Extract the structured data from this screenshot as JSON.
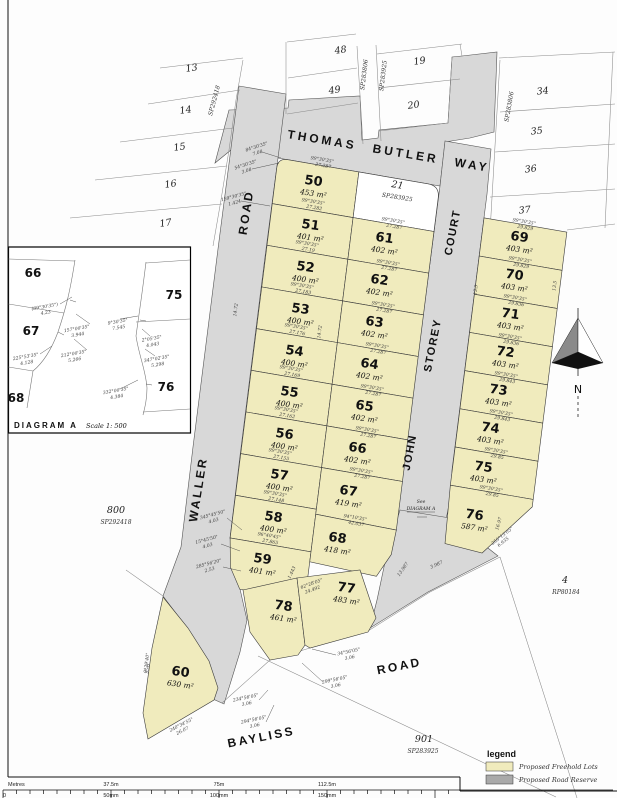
{
  "colors": {
    "lot_fill": "#f0ebbd",
    "road_fill": "#d8d8d8"
  },
  "map": {
    "roads": {
      "thomas_butler_way": "THOMAS BUTLER WAY",
      "waller": "WALLER",
      "waller_road_word": "ROAD",
      "john": "JOHN",
      "storey": "STOREY",
      "court": "COURT",
      "bayliss": "BAYLISS",
      "bayliss_road_word": "ROAD"
    },
    "north_label": "N",
    "see_note_line1": "See",
    "see_note_line2": "DIAGRAM A"
  },
  "lots": [
    {
      "n": "50",
      "a": "453 m²",
      "x": 313,
      "y": 185
    },
    {
      "n": "51",
      "a": "401 m²",
      "x": 310,
      "y": 229
    },
    {
      "n": "52",
      "a": "400 m²",
      "x": 305,
      "y": 271
    },
    {
      "n": "53",
      "a": "400 m²",
      "x": 300,
      "y": 313
    },
    {
      "n": "54",
      "a": "400 m²",
      "x": 294,
      "y": 355
    },
    {
      "n": "55",
      "a": "400 m²",
      "x": 289,
      "y": 396
    },
    {
      "n": "56",
      "a": "400 m²",
      "x": 284,
      "y": 438
    },
    {
      "n": "57",
      "a": "400 m²",
      "x": 279,
      "y": 479
    },
    {
      "n": "58",
      "a": "400 m²",
      "x": 273,
      "y": 521
    },
    {
      "n": "59",
      "a": "401 m²",
      "x": 262,
      "y": 563
    },
    {
      "n": "61",
      "a": "402 m²",
      "x": 384,
      "y": 242
    },
    {
      "n": "62",
      "a": "402 m²",
      "x": 379,
      "y": 284
    },
    {
      "n": "63",
      "a": "402 m²",
      "x": 374,
      "y": 326
    },
    {
      "n": "64",
      "a": "402 m²",
      "x": 369,
      "y": 368
    },
    {
      "n": "65",
      "a": "402 m²",
      "x": 364,
      "y": 410
    },
    {
      "n": "66",
      "a": "402 m²",
      "x": 357,
      "y": 452
    },
    {
      "n": "67",
      "a": "419 m²",
      "x": 348,
      "y": 495
    },
    {
      "n": "68",
      "a": "418 m²",
      "x": 337,
      "y": 542
    },
    {
      "n": "69",
      "a": "403 m²",
      "x": 519,
      "y": 241
    },
    {
      "n": "70",
      "a": "403 m²",
      "x": 514,
      "y": 279
    },
    {
      "n": "71",
      "a": "403 m²",
      "x": 510,
      "y": 318
    },
    {
      "n": "72",
      "a": "403 m²",
      "x": 505,
      "y": 356
    },
    {
      "n": "73",
      "a": "403 m²",
      "x": 498,
      "y": 394
    },
    {
      "n": "74",
      "a": "403 m²",
      "x": 490,
      "y": 432
    },
    {
      "n": "75",
      "a": "403 m²",
      "x": 483,
      "y": 471
    },
    {
      "n": "76",
      "a": "587 m²",
      "x": 474,
      "y": 519
    },
    {
      "n": "60",
      "a": "630 m²",
      "x": 180,
      "y": 676
    },
    {
      "n": "78",
      "a": "461 m²",
      "x": 283,
      "y": 610
    },
    {
      "n": "77",
      "a": "483 m²",
      "x": 346,
      "y": 592
    }
  ],
  "adjacent": [
    {
      "t": "13",
      "x": 192,
      "y": 71,
      "r": -8
    },
    {
      "t": "14",
      "x": 186,
      "y": 113,
      "r": -8
    },
    {
      "t": "15",
      "x": 180,
      "y": 150,
      "r": -8
    },
    {
      "t": "16",
      "x": 171,
      "y": 187,
      "r": -8
    },
    {
      "t": "17",
      "x": 166,
      "y": 226,
      "r": -8
    },
    {
      "t": "48",
      "x": 341,
      "y": 53,
      "r": -8
    },
    {
      "t": "49",
      "x": 335,
      "y": 93,
      "r": -8
    },
    {
      "t": "19",
      "x": 420,
      "y": 64,
      "r": -8
    },
    {
      "t": "20",
      "x": 414,
      "y": 108,
      "r": -8
    },
    {
      "t": "34",
      "x": 543,
      "y": 94,
      "r": -6
    },
    {
      "t": "35",
      "x": 537,
      "y": 134,
      "r": -6
    },
    {
      "t": "36",
      "x": 531,
      "y": 172,
      "r": -6
    },
    {
      "t": "37",
      "x": 525,
      "y": 213,
      "r": -6
    },
    {
      "t": "21",
      "x": 397,
      "y": 188,
      "r": 9
    },
    {
      "t": "800",
      "x": 116,
      "y": 513,
      "r": 0
    },
    {
      "t": "901",
      "x": 424,
      "y": 742,
      "r": 0
    },
    {
      "t": "4",
      "x": 565,
      "y": 583,
      "r": 0
    }
  ],
  "plans": [
    {
      "t": "SP283925",
      "x": 397,
      "y": 199,
      "r": 9
    },
    {
      "t": "SP292418",
      "x": 116,
      "y": 524,
      "r": 0
    },
    {
      "t": "SP283925",
      "x": 423,
      "y": 753,
      "r": 0
    },
    {
      "t": "RP80184",
      "x": 566,
      "y": 594,
      "r": 0
    },
    {
      "t": "SP283806",
      "x": 366,
      "y": 75,
      "r": -83
    },
    {
      "t": "SP283925",
      "x": 385,
      "y": 76,
      "r": -83
    },
    {
      "t": "SP283806",
      "x": 511,
      "y": 107,
      "r": -80
    },
    {
      "t": "SP292418",
      "x": 216,
      "y": 101,
      "r": -75
    }
  ],
  "annotations": [
    {
      "b": "99°30'35\"",
      "d": "27.287",
      "x": 322,
      "y": 161,
      "r": 9.5
    },
    {
      "b": "99°30'35\"",
      "d": "27.282",
      "x": 313,
      "y": 203,
      "r": 9.5
    },
    {
      "b": "99°30'35\"",
      "d": "27.19",
      "x": 307,
      "y": 245,
      "r": 9.5
    },
    {
      "b": "99°30'35\"",
      "d": "27.183",
      "x": 302,
      "y": 287,
      "r": 9.5
    },
    {
      "b": "99°30'35\"",
      "d": "27.176",
      "x": 296,
      "y": 328,
      "r": 9.5
    },
    {
      "b": "99°30'35\"",
      "d": "27.169",
      "x": 291,
      "y": 370,
      "r": 9.5
    },
    {
      "b": "99°30'35\"",
      "d": "27.162",
      "x": 286,
      "y": 411,
      "r": 9.5
    },
    {
      "b": "99°30'35\"",
      "d": "27.155",
      "x": 280,
      "y": 453,
      "r": 9.5
    },
    {
      "b": "99°30'35\"",
      "d": "27.148",
      "x": 275,
      "y": 495,
      "r": 9.5
    },
    {
      "b": "96°40'45\"",
      "d": "27.865",
      "x": 269,
      "y": 537,
      "r": 9.5
    },
    {
      "b": "99°30'35\"",
      "d": "27.287",
      "x": 393,
      "y": 222,
      "r": 9.5
    },
    {
      "b": "99°30'35\"",
      "d": "27.287",
      "x": 388,
      "y": 264,
      "r": 9.5
    },
    {
      "b": "99°30'35\"",
      "d": "27.287",
      "x": 383,
      "y": 306,
      "r": 9.5
    },
    {
      "b": "99°30'35\"",
      "d": "27.287",
      "x": 377,
      "y": 347,
      "r": 9.5
    },
    {
      "b": "99°30'35\"",
      "d": "27.287",
      "x": 372,
      "y": 389,
      "r": 9.5
    },
    {
      "b": "99°30'35\"",
      "d": "27.287",
      "x": 367,
      "y": 431,
      "r": 9.5
    },
    {
      "b": "99°30'35\"",
      "d": "27.287",
      "x": 361,
      "y": 472,
      "r": 9.5
    },
    {
      "b": "94°10'35\"",
      "d": "42.037",
      "x": 355,
      "y": 519,
      "r": 9.5
    },
    {
      "b": "99°30'35\"",
      "d": "29.829",
      "x": 524,
      "y": 223,
      "r": 9.5
    },
    {
      "b": "99°30'35\"",
      "d": "29.829",
      "x": 520,
      "y": 261,
      "r": 9.5
    },
    {
      "b": "99°30'35\"",
      "d": "29.836",
      "x": 515,
      "y": 299,
      "r": 9.5
    },
    {
      "b": "99°30'35\"",
      "d": "29.836",
      "x": 510,
      "y": 338,
      "r": 9.5
    },
    {
      "b": "99°30'35\"",
      "d": "29.843",
      "x": 506,
      "y": 376,
      "r": 9.5
    },
    {
      "b": "99°30'35\"",
      "d": "29.843",
      "x": 501,
      "y": 414,
      "r": 9.5
    },
    {
      "b": "99°30'35\"",
      "d": "29.85",
      "x": 496,
      "y": 452,
      "r": 9.5
    },
    {
      "b": "99°30'35\"",
      "d": "29.85",
      "x": 491,
      "y": 490,
      "r": 9.5
    },
    {
      "b": "255°13'05\"",
      "d": "6.935",
      "x": 503,
      "y": 537,
      "r": -38
    },
    {
      "b": "9°29'40\"",
      "d": "35.6",
      "x": 148,
      "y": 663,
      "r": -83
    },
    {
      "b": "240°34'55\"",
      "d": "26.07",
      "x": 182,
      "y": 726,
      "r": -27
    },
    {
      "b": "84°30'35\"",
      "d": "7.08",
      "x": 257,
      "y": 148,
      "r": -18
    },
    {
      "b": "54°30'35\"",
      "d": "3.08",
      "x": 246,
      "y": 166,
      "r": -18
    },
    {
      "b": "159°30'35\"",
      "d": "1.424",
      "x": 234,
      "y": 198,
      "r": -15
    },
    {
      "b": "345°45'50\"",
      "d": "4.03",
      "x": 213,
      "y": 516,
      "r": -15
    },
    {
      "b": "15°45'50\"",
      "d": "4.03",
      "x": 207,
      "y": 541,
      "r": -15
    },
    {
      "b": "285°56'20\"",
      "d": "2.53",
      "x": 209,
      "y": 565,
      "r": -15
    },
    {
      "b": "34°56'05\"",
      "d": "3.06",
      "x": 349,
      "y": 653,
      "r": -12
    },
    {
      "b": "299°56'05\"",
      "d": "3.06",
      "x": 335,
      "y": 681,
      "r": -12
    },
    {
      "b": "234°56'05\"",
      "d": "3.06",
      "x": 246,
      "y": 699,
      "r": -12
    },
    {
      "b": "294°56'05\"",
      "d": "3.06",
      "x": 254,
      "y": 721,
      "r": -12
    },
    {
      "b": "62°28'05\"",
      "d": "24.492",
      "x": 312,
      "y": 585,
      "r": -20
    },
    {
      "b": "14.72",
      "d": "",
      "x": 237,
      "y": 310,
      "r": -83
    },
    {
      "b": "14.72",
      "d": "",
      "x": 321,
      "y": 332,
      "r": -83
    },
    {
      "b": "13.5",
      "d": "",
      "x": 477,
      "y": 290,
      "r": -83
    },
    {
      "b": "13.5",
      "d": "",
      "x": 556,
      "y": 286,
      "r": -83
    },
    {
      "b": "16.97",
      "d": "",
      "x": 500,
      "y": 524,
      "r": -75
    },
    {
      "b": "13.987",
      "d": "",
      "x": 404,
      "y": 570,
      "r": -55
    },
    {
      "b": "3.987",
      "d": "",
      "x": 437,
      "y": 566,
      "r": -25
    },
    {
      "b": "1.443",
      "d": "",
      "x": 293,
      "y": 573,
      "r": -65
    }
  ],
  "inset": {
    "diagram_label": "DIAGRAM  A",
    "scale_label": "Scale 1: 500",
    "numbers": [
      {
        "t": "66",
        "x": 33,
        "y": 277
      },
      {
        "t": "75",
        "x": 174,
        "y": 299
      },
      {
        "t": "67",
        "x": 31,
        "y": 335
      },
      {
        "t": "68",
        "x": 16,
        "y": 402
      },
      {
        "t": "76",
        "x": 166,
        "y": 391
      }
    ],
    "annotations": [
      {
        "b": "(89°30'35\")",
        "d": "4.23",
        "x": 45,
        "y": 308,
        "r": -10
      },
      {
        "b": "157°00'35\"",
        "d": "3.944",
        "x": 77,
        "y": 330,
        "r": -10
      },
      {
        "b": "212°00'35\"",
        "d": "5.266",
        "x": 74,
        "y": 355,
        "r": -10
      },
      {
        "b": "225°53'35\"",
        "d": "4.128",
        "x": 26,
        "y": 358,
        "r": -10
      },
      {
        "b": "9°30'35\"",
        "d": "7.545",
        "x": 118,
        "y": 323,
        "r": -10
      },
      {
        "b": "2°05'35\"",
        "d": "4.043",
        "x": 152,
        "y": 340,
        "r": -10
      },
      {
        "b": "347°02'35\"",
        "d": "5.298",
        "x": 157,
        "y": 360,
        "r": -10
      },
      {
        "b": "332°00'35\"",
        "d": "4.384",
        "x": 116,
        "y": 392,
        "r": -10
      }
    ]
  },
  "legend": {
    "title": "legend",
    "items": [
      {
        "label": "Proposed Freehold Lots",
        "color": "#f0ebbd"
      },
      {
        "label": "Proposed Road Reserve",
        "color": "#a9a9a9"
      }
    ]
  },
  "scalebar": {
    "row1": [
      "Metres",
      "37.5m",
      "75m",
      "112.5m"
    ],
    "row2": [
      "0",
      "50mm",
      "100mm",
      "150mm"
    ]
  }
}
